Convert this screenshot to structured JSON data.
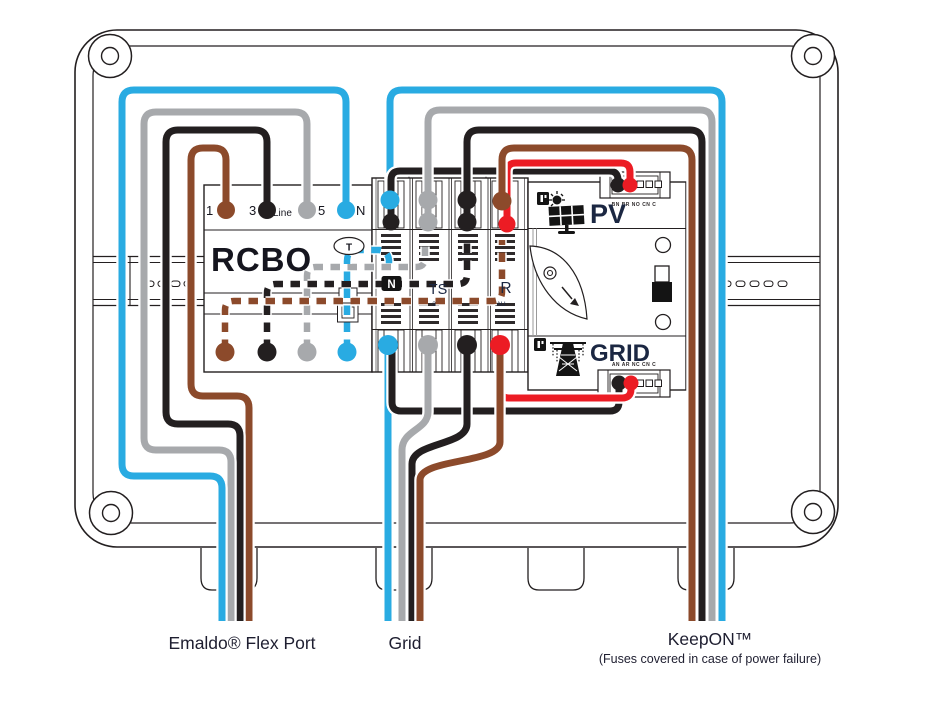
{
  "colors": {
    "blue": "#29ABE2",
    "gray": "#A7A9AC",
    "black": "#231F20",
    "brown": "#8C4A2B",
    "red": "#EC1C24",
    "navy": "#1B2742",
    "caption": "#1E1E30",
    "ink": "#231F20"
  },
  "captions": {
    "flex_port": "Emaldo® Flex Port",
    "grid": "Grid",
    "keepon": "KeepON™",
    "keepon_note": "(Fuses covered in case of power failure)"
  },
  "rcbo": {
    "title": "RCBO",
    "terminal_1": "1",
    "terminal_3": "3",
    "terminal_line": "Line",
    "terminal_5": "5",
    "terminal_n": "N",
    "test_button": "T"
  },
  "switch": {
    "label_n": "N",
    "label_ts": "TS",
    "label_r": "R",
    "label_3": "3",
    "label_au": "AU"
  },
  "meter": {
    "pv": "PV",
    "grid": "GRID",
    "top_pins": "BN BR NO CN C",
    "bottom_pins": "AN AR NC CN C"
  }
}
